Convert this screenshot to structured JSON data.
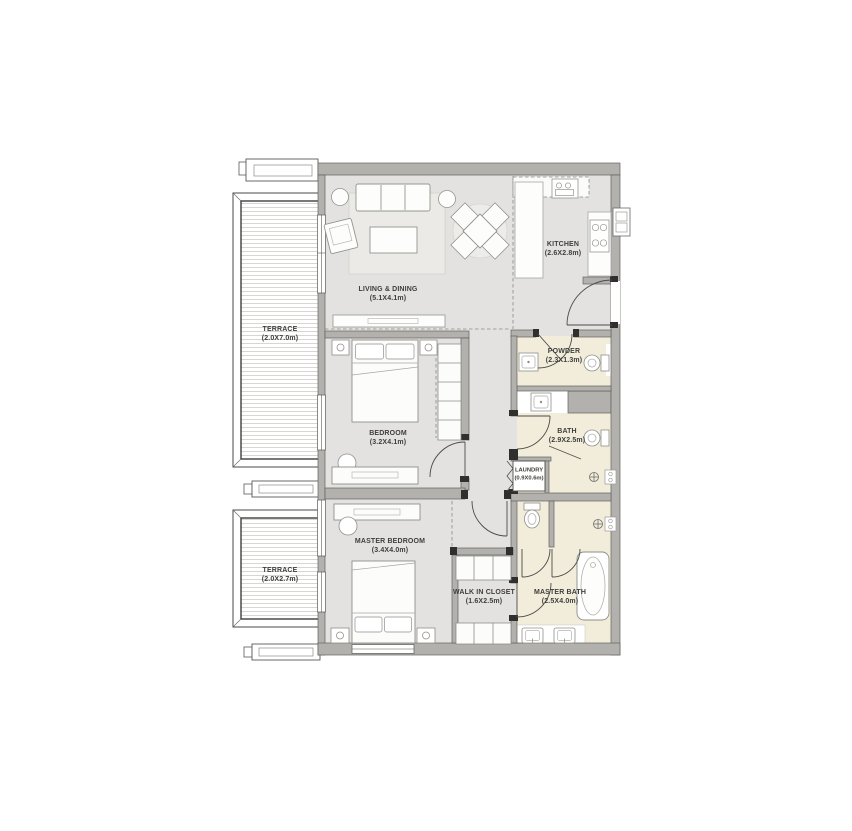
{
  "plan": {
    "title": "apartment-floor-plan",
    "rooms": [
      {
        "id": "terrace-top",
        "name": "TERRACE",
        "dims": "(2.0X7.0m)"
      },
      {
        "id": "living-dining",
        "name": "LIVING & DINING",
        "dims": "(5.1X4.1m)"
      },
      {
        "id": "kitchen",
        "name": "KITCHEN",
        "dims": "(2.6X2.8m)"
      },
      {
        "id": "powder",
        "name": "POWDER",
        "dims": "(2.3X1.3m)"
      },
      {
        "id": "bedroom",
        "name": "BEDROOM",
        "dims": "(3.2X4.1m)"
      },
      {
        "id": "bath",
        "name": "BATH",
        "dims": "(2.9X2.5m)"
      },
      {
        "id": "laundry",
        "name": "LAUNDRY",
        "dims": "(0.9X0.6m)"
      },
      {
        "id": "master-bedroom",
        "name": "MASTER BEDROOM",
        "dims": "(3.4X4.0m)"
      },
      {
        "id": "terrace-bottom",
        "name": "TERRACE",
        "dims": "(2.0X2.7m)"
      },
      {
        "id": "walk-in-closet",
        "name": "WALK IN CLOSET",
        "dims": "(1.6X2.5m)"
      },
      {
        "id": "master-bath",
        "name": "MASTER BATH",
        "dims": "(2.5X4.0m)"
      }
    ],
    "colors": {
      "wall": "#b2b1ae",
      "floor": "#e3e2e0",
      "wet_room": "#f2ecda",
      "deck_hatch": "#d7d6d3",
      "line": "#4b4b47",
      "text": "#3e3e3c",
      "background": "#ffffff"
    }
  }
}
